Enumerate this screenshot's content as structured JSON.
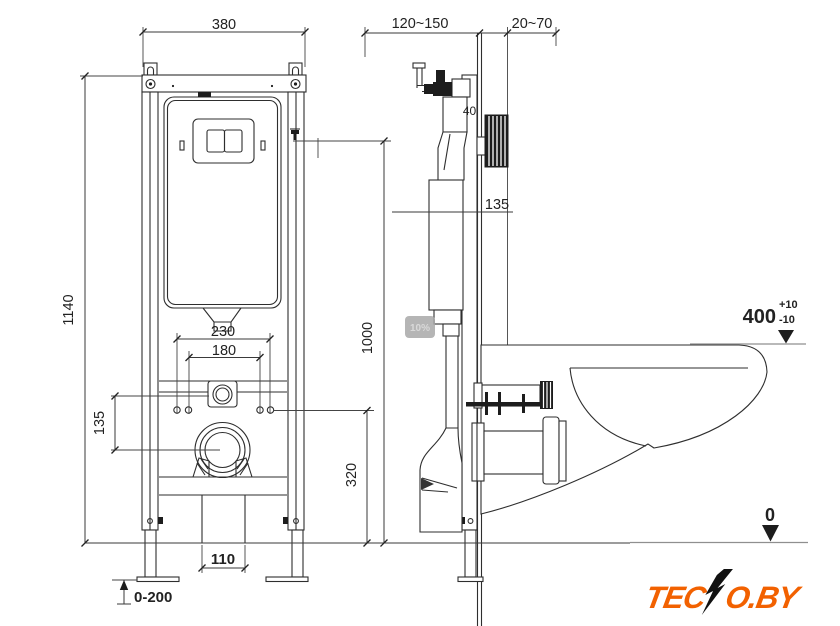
{
  "title": "Wall-hung toilet concealed frame installation drawing",
  "front_view": {
    "frame_width": "380",
    "frame_height": "1140",
    "fixing_spacing_outer": "230",
    "fixing_spacing_inner": "180",
    "inlet_drain_offset": "135",
    "drain_center_height": "320",
    "actuator_height": "1000",
    "outlet_width": "110",
    "foot_adjustment": "0-200"
  },
  "side_view": {
    "frame_depth_range": "120~150",
    "finish_thickness_range": "20~70",
    "profile_depth": "40",
    "cistern_offset": "135",
    "bowl_rim_height": "400",
    "tolerance_plus": "+10",
    "tolerance_minus": "-10",
    "floor_level": "0"
  },
  "watermark": {
    "label": "10%"
  },
  "logo": {
    "full": "TECNO.BY",
    "part1": "TEC",
    "part2": "O.BY"
  },
  "colors": {
    "line": "#2e2e2e",
    "datum_gray": "#8f8f8f",
    "logo_orange": "#f26100",
    "logo_black": "#111111",
    "watermark_gray": "#a8a8a8"
  }
}
